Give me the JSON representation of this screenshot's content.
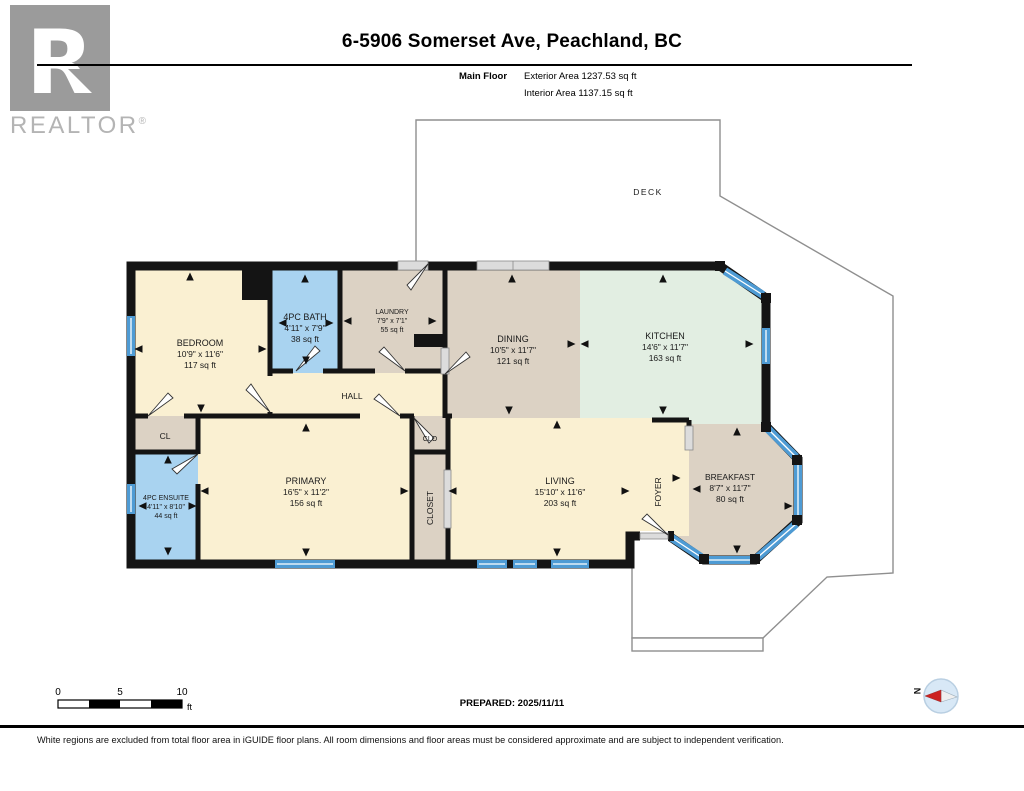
{
  "header": {
    "title": "6-5906 Somerset Ave, Peachland, BC",
    "floor_label": "Main Floor",
    "exterior_area": "Exterior Area 1237.53 sq ft",
    "interior_area": "Interior Area 1137.15 sq ft"
  },
  "logo": {
    "letter": "R",
    "brand": "REALTOR",
    "reg": "®"
  },
  "plan": {
    "deck": {
      "name": "DECK"
    },
    "bedroom": {
      "name": "BEDROOM",
      "dims": "10'9\" x 11'6\"",
      "area": "117 sq ft"
    },
    "bath": {
      "name": "4PC BATH",
      "dims": "4'11\" x 7'9\"",
      "area": "38 sq ft"
    },
    "laundry": {
      "name": "LAUNDRY",
      "dims": "7'9\" x 7'1\"",
      "area": "55 sq ft"
    },
    "dining": {
      "name": "DINING",
      "dims": "10'5\" x 11'7\"",
      "area": "121 sq ft"
    },
    "kitchen": {
      "name": "KITCHEN",
      "dims": "14'6\" x 11'7\"",
      "area": "163 sq ft"
    },
    "hall": {
      "name": "HALL"
    },
    "cl": {
      "name": "CL"
    },
    "ensuite": {
      "name": "4PC ENSUITE",
      "dims": "4'11\" x 8'10\"",
      "area": "44 sq ft"
    },
    "primary": {
      "name": "PRIMARY",
      "dims": "16'5\" x 11'2\"",
      "area": "156 sq ft"
    },
    "clo": {
      "name": "CLO"
    },
    "closet": {
      "name": "CLOSET"
    },
    "living": {
      "name": "LIVING",
      "dims": "15'10\" x 11'6\"",
      "area": "203 sq ft"
    },
    "foyer": {
      "name": "FOYER"
    },
    "breakfast": {
      "name": "BREAKFAST",
      "dims": "8'7\" x 11'7\"",
      "area": "80 sq ft"
    }
  },
  "scale": {
    "t0": "0",
    "t5": "5",
    "t10": "10",
    "unit": "ft"
  },
  "prepared": "PREPARED: 2025/11/11",
  "compass": {
    "north": "N"
  },
  "disclaimer": "White regions are excluded from total floor area in iGUIDE floor plans. All room dimensions and floor areas must be considered approximate and are subject to independent verification.",
  "colors": {
    "cream": "#FAF0D2",
    "blue_room": "#A9D3F0",
    "greige": "#DCD2C4",
    "mint": "#E2EEE2",
    "window": "#4E9BD4",
    "wall": "#141414"
  }
}
